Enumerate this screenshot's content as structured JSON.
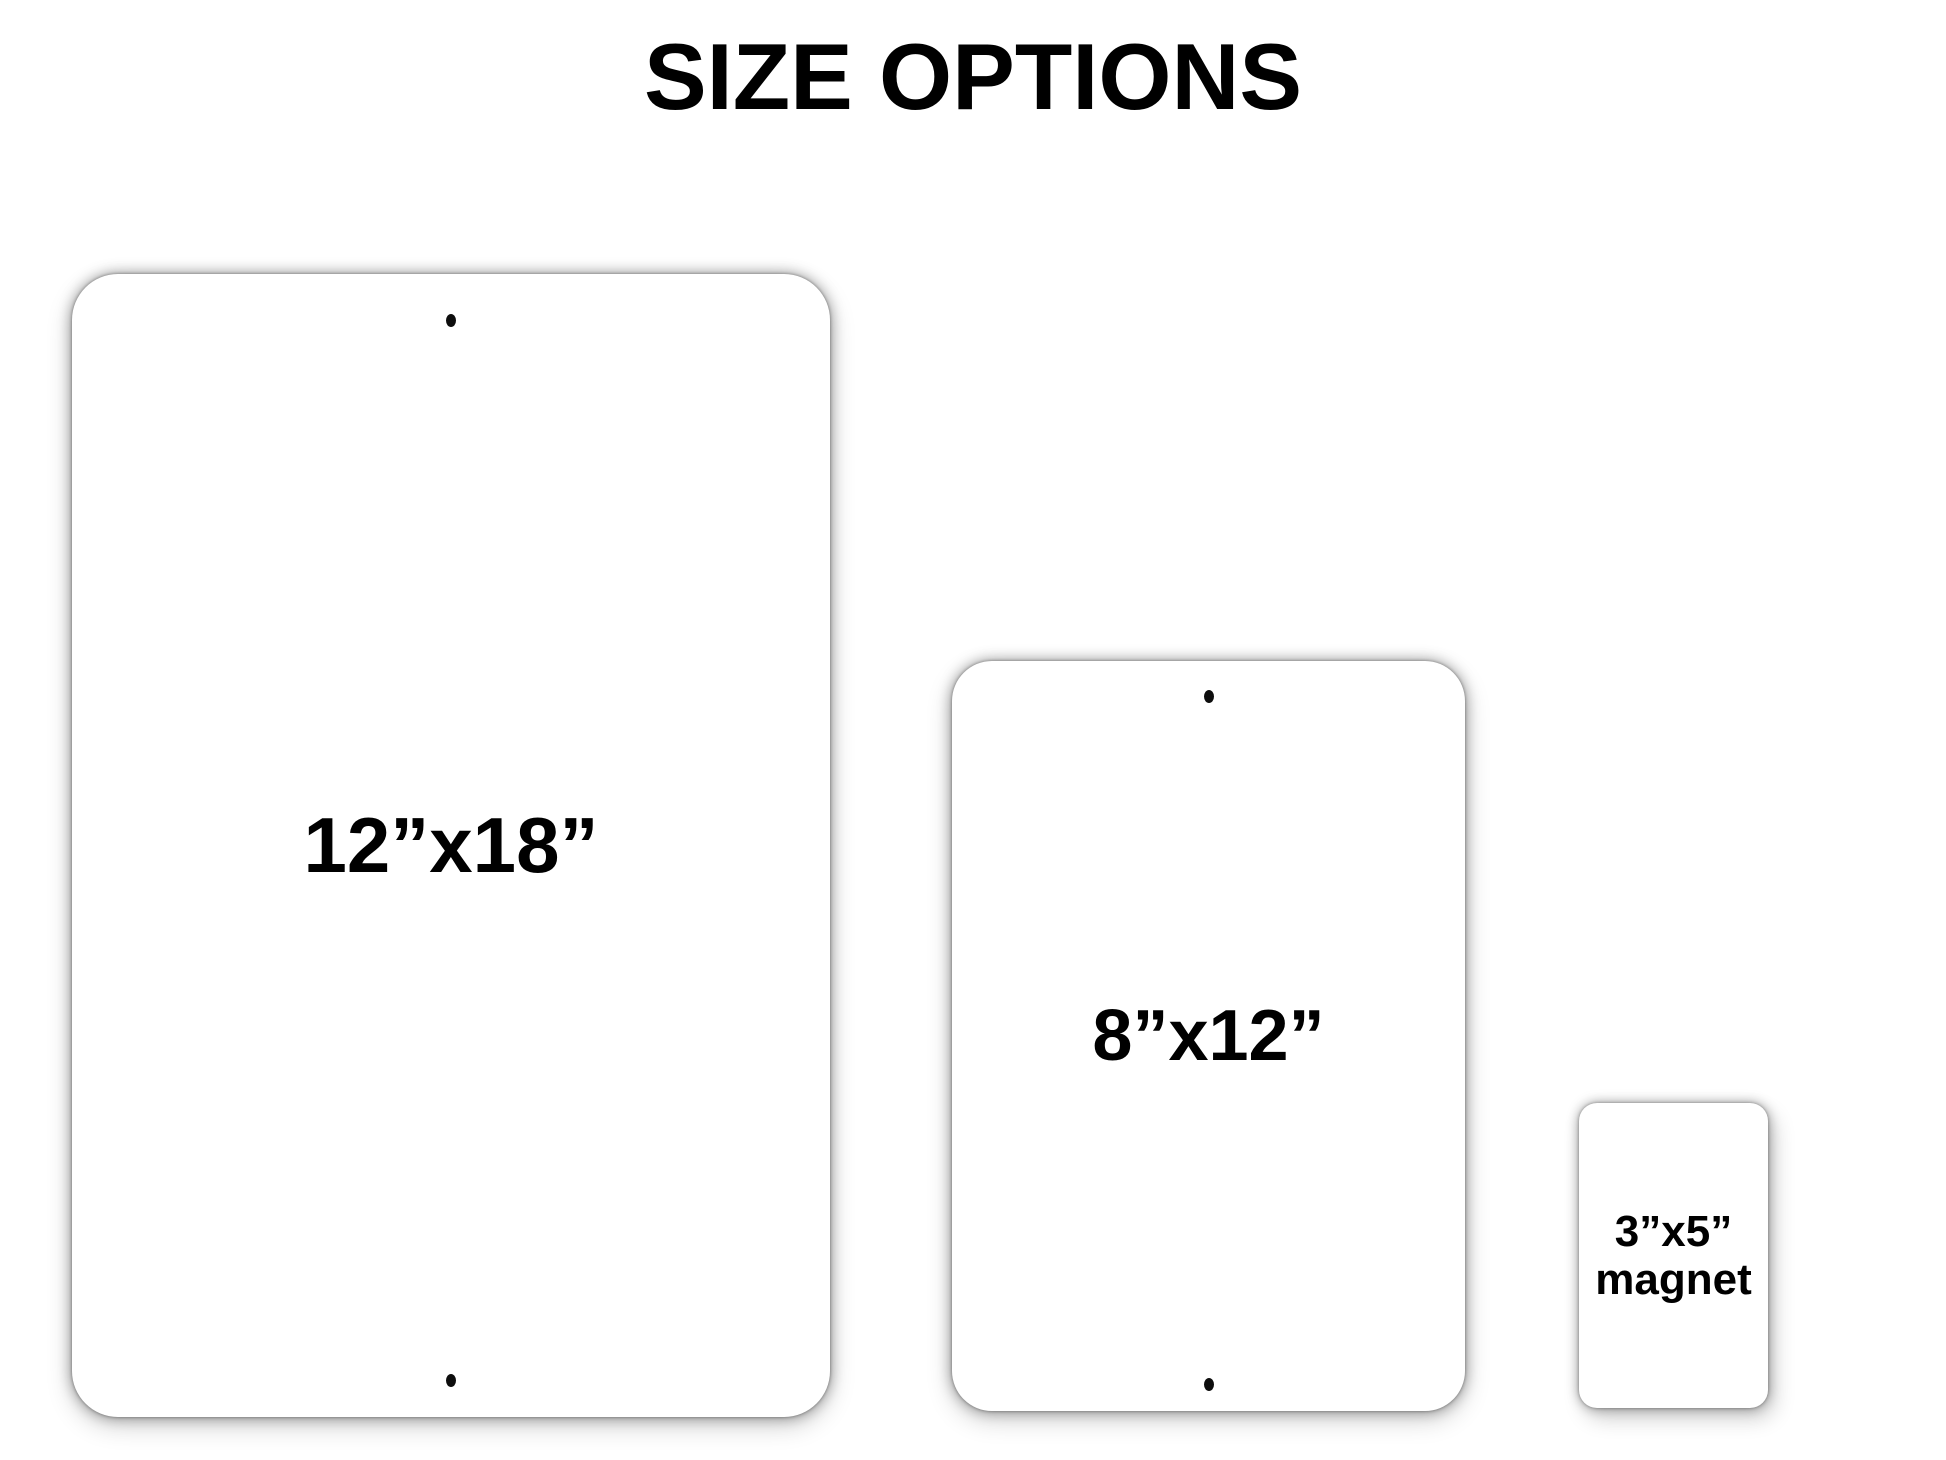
{
  "title": "SIZE OPTIONS",
  "signs": [
    {
      "id": "sign-12x18",
      "label": "12”x18”",
      "hole_count": 2
    },
    {
      "id": "sign-8x12",
      "label": "8”x12”",
      "hole_count": 2
    },
    {
      "id": "magnet-3x5",
      "label_line1": "3”x5”",
      "label_line2": "magnet",
      "hole_count": 0
    }
  ],
  "colors": {
    "background": "#ffffff",
    "sign_face": "#ffffff",
    "text": "#000000",
    "hole": "#0d0d0d",
    "shadow": "rgba(0,0,0,0.40)"
  }
}
